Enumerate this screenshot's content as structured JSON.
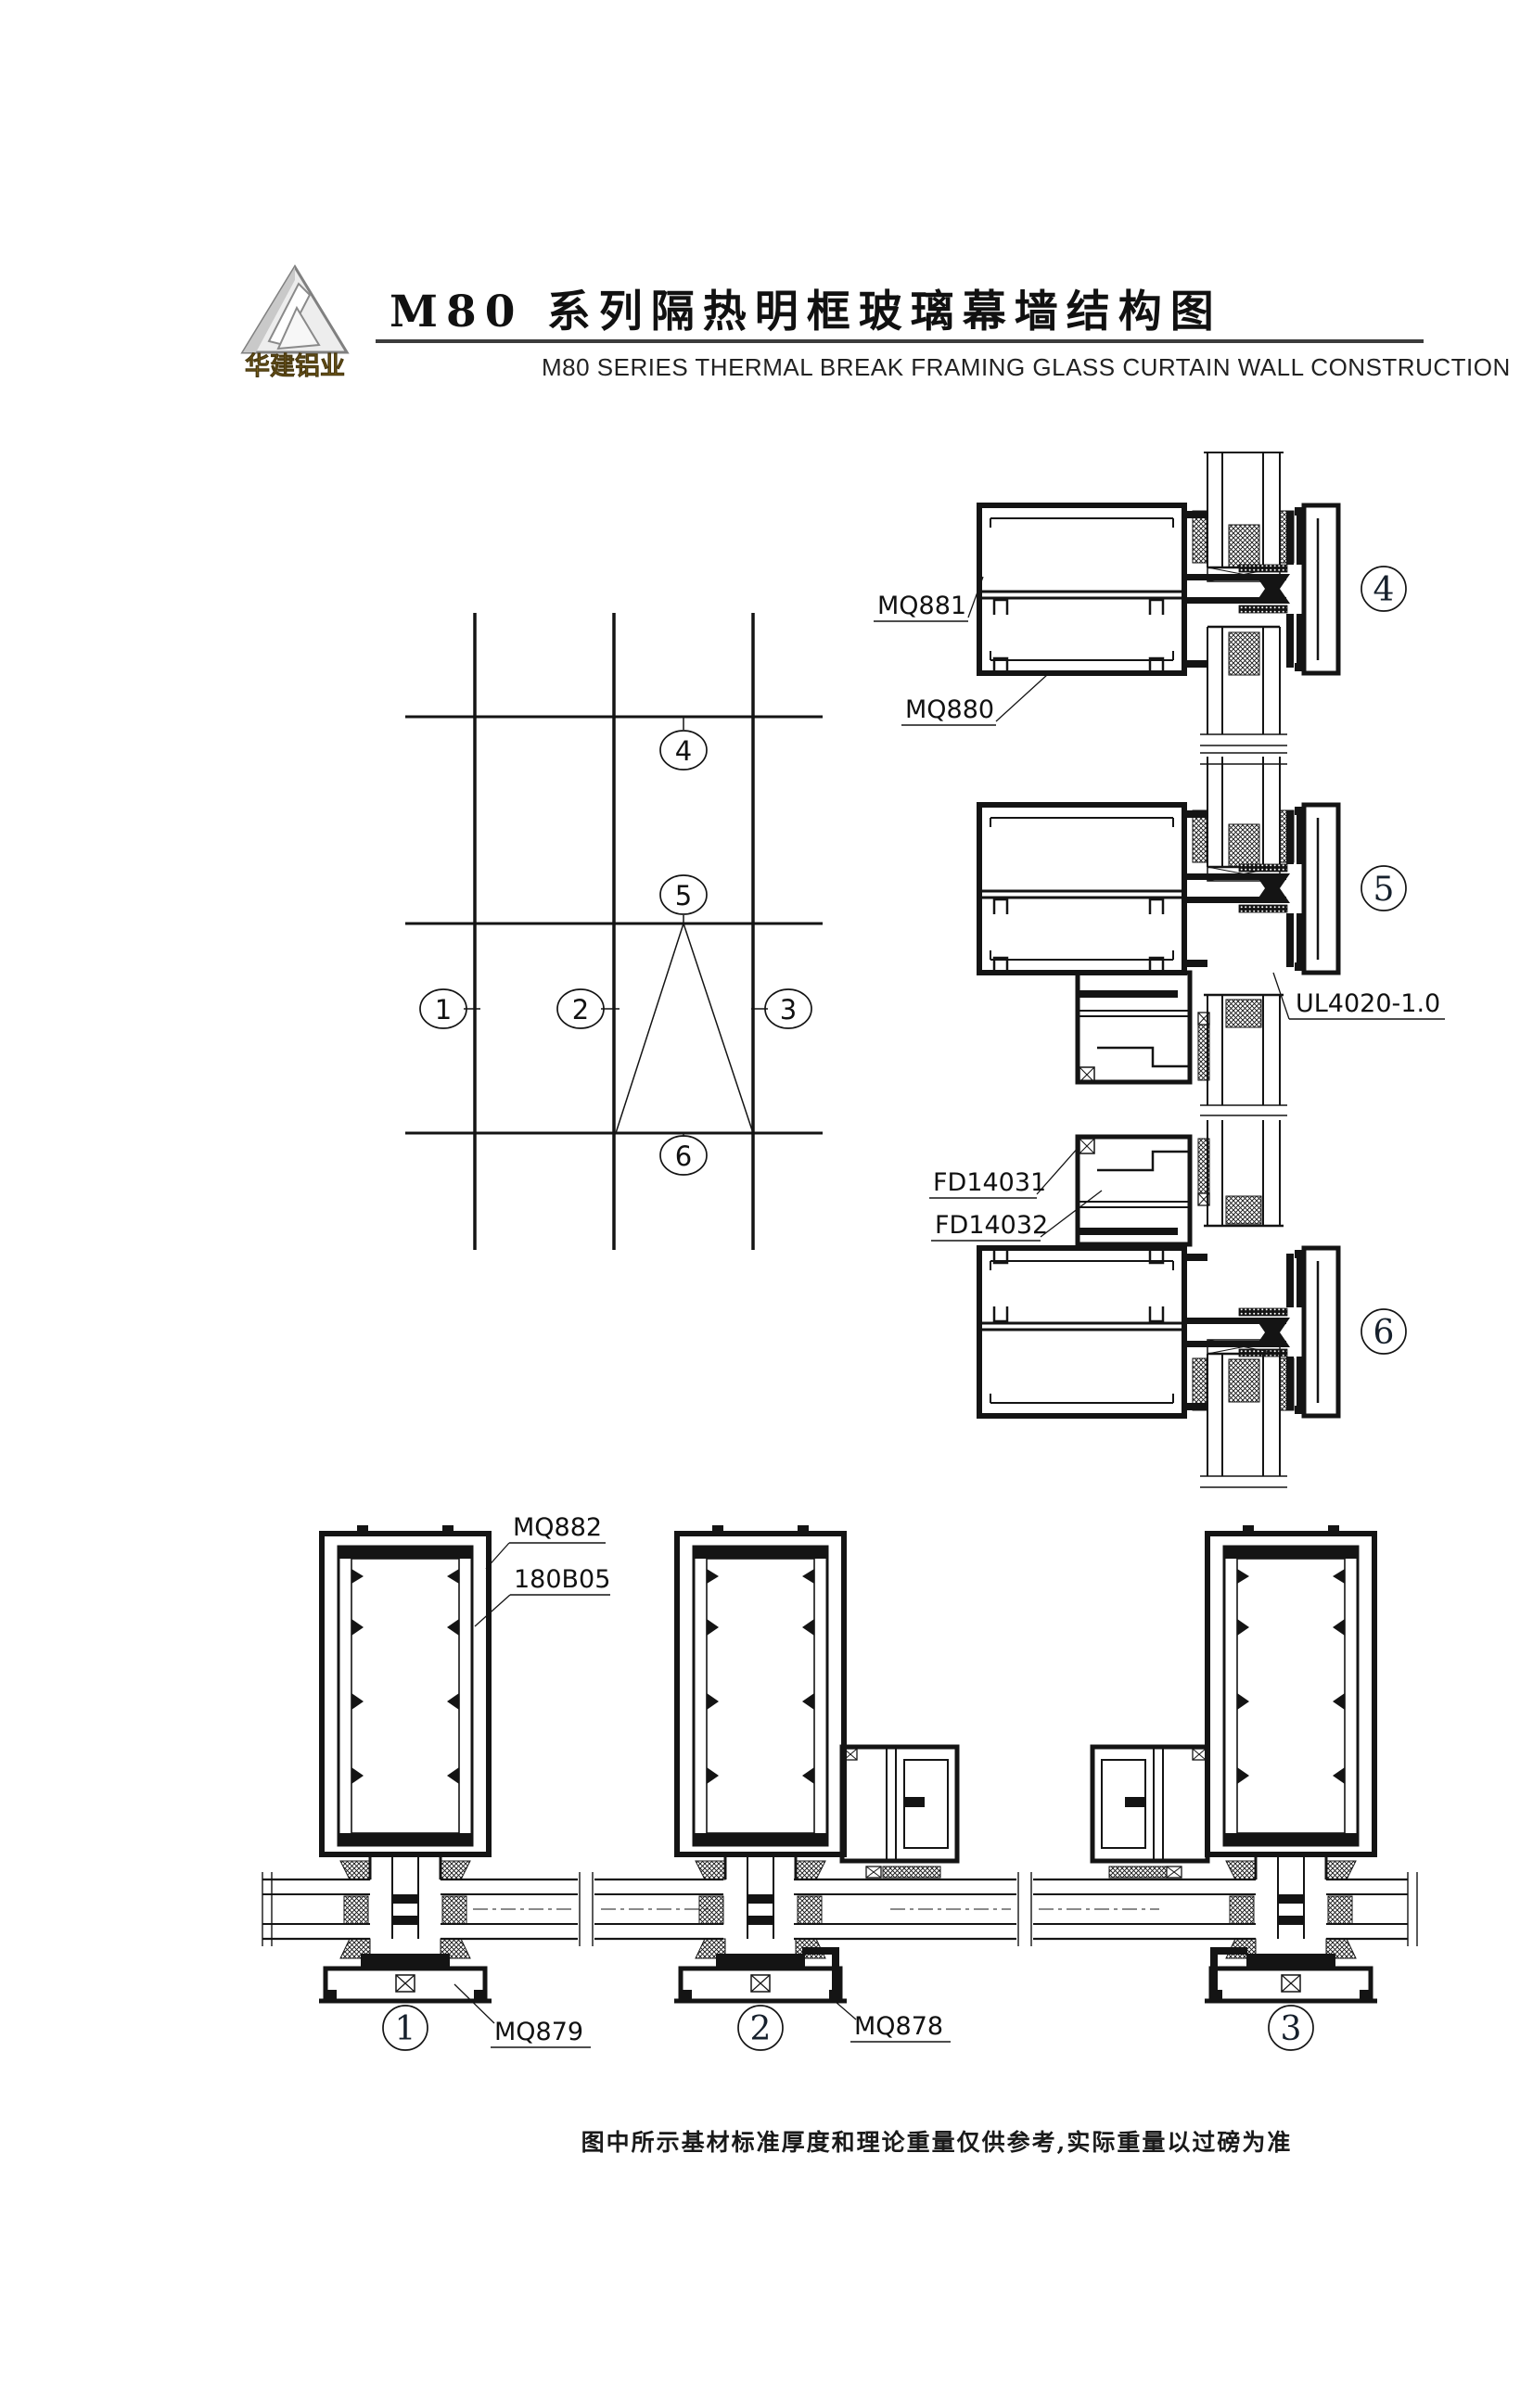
{
  "header": {
    "logo_text": "华建铝业",
    "title_cn": "M80 系列隔热明框玻璃幕墙结构图",
    "title_en": "M80 SERIES THERMAL BREAK FRAMING GLASS CURTAIN WALL CONSTRUCTION"
  },
  "labels": {
    "mq881": "MQ881",
    "mq880": "MQ880",
    "ul4020": "UL4020-1.0",
    "fd14031": "FD14031",
    "fd14032": "FD14032",
    "mq882": "MQ882",
    "b180b05": "180B05",
    "mq879": "MQ879",
    "mq878": "MQ878"
  },
  "callouts": {
    "c1": "1",
    "c2": "2",
    "c3": "3",
    "c4": "4",
    "c5": "5",
    "c6": "6"
  },
  "footer": {
    "note": "图中所示基材标准厚度和理论重量仅供参考,实际重量以过磅为准"
  },
  "colors": {
    "line": "#141414",
    "gold": "#8f7020",
    "silver_fill": "#ededed",
    "silver_edge": "#808080"
  }
}
